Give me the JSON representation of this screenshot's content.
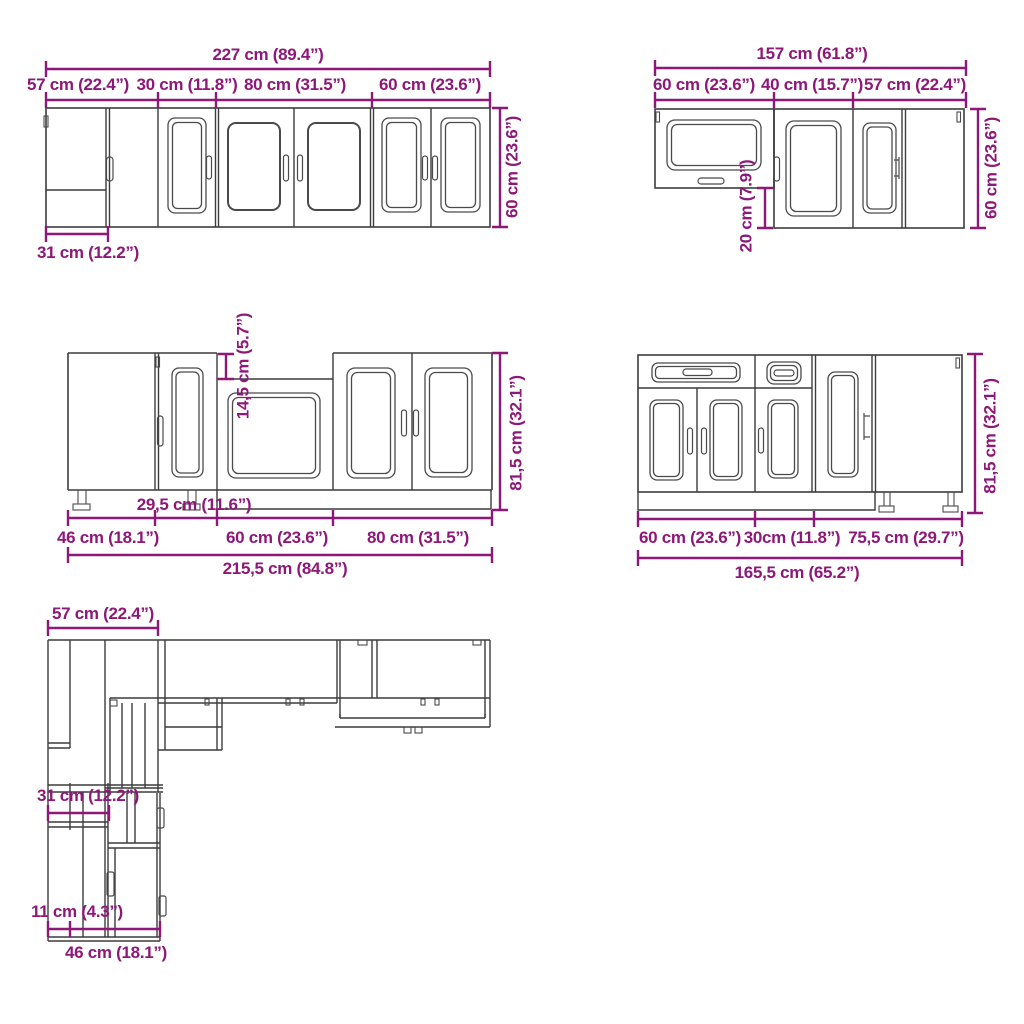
{
  "colors": {
    "dimension": "#8e1878",
    "line": "#3c3c3c"
  },
  "diagrams": {
    "wall_row_front": {
      "total_width": "227 cm (89.4”)",
      "segments": [
        "57 cm (22.4”)",
        "30 cm (11.8”)",
        "80 cm (31.5”)",
        "60 cm (23.6”)"
      ],
      "height": "60 cm (23.6”)",
      "corner_width": "31 cm (12.2”)"
    },
    "wall_corner_front": {
      "total_width": "157 cm (61.8”)",
      "segments": [
        "60 cm (23.6”)",
        "40 cm (15.7”)",
        "57 cm (22.4”)"
      ],
      "height": "60 cm (23.6”)",
      "offset": "20 cm (7.9”)"
    },
    "base_row_front": {
      "recess_height": "14,5 cm (5.7”)",
      "height": "81,5 cm (32.1”)",
      "inner_width": "29,5 cm (11.6”)",
      "segments": [
        "46 cm (18.1”)",
        "60 cm (23.6”)",
        "80 cm (31.5”)"
      ],
      "total_width": "215,5 cm (84.8”)"
    },
    "base_corner_front": {
      "height": "81,5 cm (32.1”)",
      "segments": [
        "60 cm (23.6”)",
        "30cm (11.8”)",
        "75,5 cm (29.7”)"
      ],
      "total_width": "165,5 cm (65.2”)"
    },
    "floor_plan": {
      "top_width": "57 cm (22.4”)",
      "mid_width": "31 cm (12.2”)",
      "small_width": "11 cm (4.3”)",
      "lower_width": "46 cm (18.1”)"
    }
  }
}
